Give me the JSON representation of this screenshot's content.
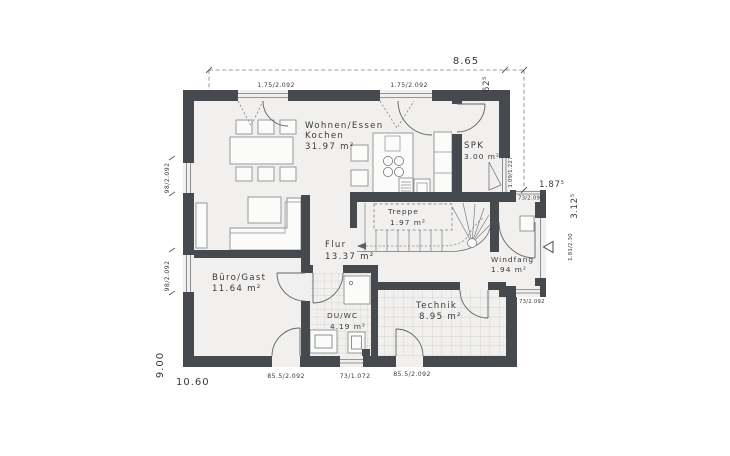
{
  "colors": {
    "wall-color": "#46494e",
    "floor-color": "#f1f0ee",
    "paper-color": "#ffffff",
    "text-color": "#3a3a3c"
  },
  "rooms": {
    "wohnen": {
      "name_line1": "Wohnen/Essen",
      "name_line2": "Kochen",
      "area": "31.97 m²"
    },
    "spk": {
      "name": "SPK",
      "area": "3.00 m²"
    },
    "treppe": {
      "name": "Treppe",
      "area": "1.97 m²"
    },
    "flur": {
      "name": "Flur",
      "area": "13.37 m²"
    },
    "buero": {
      "name": "Büro/Gast",
      "area": "11.64 m²"
    },
    "duwc": {
      "name": "DU/WC",
      "area": "4.19 m²"
    },
    "technik": {
      "name": "Technik",
      "area": "8.95 m²"
    },
    "windfang": {
      "name": "Windfang",
      "area": "1.94 m²"
    }
  },
  "dimensions": {
    "top_total": "8.65",
    "top_overhang": "62⁵",
    "left_total": "9.00",
    "bottom_total": "10.60",
    "right_upper": "1.87⁵",
    "right_windfang": "3.12⁵"
  },
  "openings": {
    "top_window_left": "1.75/2.092",
    "top_window_right": "1.75/2.092",
    "left_window_upper": "98/2.092",
    "left_window_lower": "98/2.092",
    "spk_window": "1.09/1.227",
    "windfang_window_top": "73/2.092",
    "windfang_window_bottom": "73/2.092",
    "entry_door": "1.81/2.30",
    "buero_terrace_door": "85.5/2.092",
    "duwc_window": "73/1.072",
    "technik_door": "85.5/2.092"
  }
}
